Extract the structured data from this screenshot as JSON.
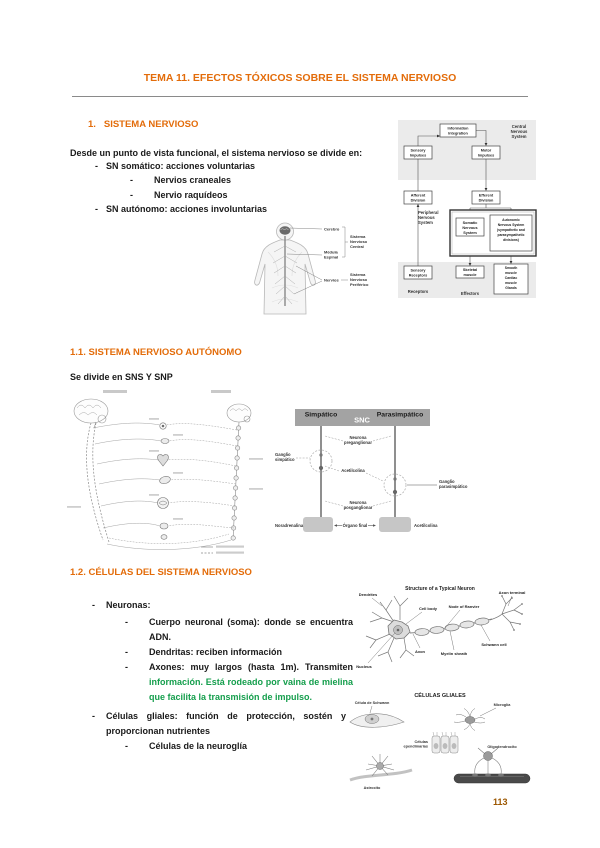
{
  "glyphs": {
    "dash": "-"
  },
  "doc": {
    "title": "TEMA 11. EFECTOS TÓXICOS SOBRE EL SISTEMA NERVIOSO",
    "page_number": "113"
  },
  "s1": {
    "heading_num": "1.",
    "heading": "SISTEMA NERVIOSO",
    "intro": "Desde un punto de vista funcional, el sistema nervioso se divide en:",
    "b1": "SN somático: acciones voluntarias",
    "b1a": "Nervios craneales",
    "b1b": "Nervio raquídeos",
    "b2": "SN autónomo: acciones involuntarias"
  },
  "s11": {
    "heading": "1.1. SISTEMA NERVIOSO AUTÓNOMO",
    "intro": "Se divide en SNS Y SNP"
  },
  "s12": {
    "heading": "1.2. CÉLULAS DEL SISTEMA NERVIOSO",
    "b1": "Neuronas:",
    "b1a": "Cuerpo neuronal (soma): donde se encuentra ADN.",
    "b1b": "Dendritas: reciben información",
    "b1c_black": "Axones: muy largos (hasta 1m). Transmiten ",
    "b1c_green": "información. Está rodeado por vaina de mielina que facilita la transmisión de impulso.",
    "b2": "Células gliales: función de protección, sostén y proporcionan nutrientes",
    "b2a": "Células de la neuroglía"
  },
  "flowchart": {
    "cns": [
      "Central",
      "Nervous",
      "System"
    ],
    "pns": [
      "Peripheral",
      "Nervous",
      "System"
    ],
    "info_integration": [
      "Information",
      "Integration"
    ],
    "sensory_impulses": [
      "Sensory",
      "Impulses"
    ],
    "motor_impulses": [
      "Motor",
      "Impulses"
    ],
    "afferent": [
      "Afferent",
      "Division"
    ],
    "efferent": [
      "Efferent",
      "Division"
    ],
    "somatic": [
      "Somatic",
      "Nervous",
      "System"
    ],
    "autonomic": [
      "Autonomic",
      "Nervous System",
      "(sympathetic and",
      "parasympathetic",
      "divisions)"
    ],
    "sensory_receptors": [
      "Sensory",
      "Receptors"
    ],
    "skeletal": [
      "Skeletal",
      "muscle"
    ],
    "smooth": [
      "Smooth",
      "muscle",
      "Cardiac",
      "muscle",
      "Glands"
    ],
    "receptors": "Receptors",
    "effectors": "Effectors"
  },
  "body_figure": {
    "cerebro": "Cerebro",
    "medula": [
      "Médula",
      "Espinal"
    ],
    "nervios": "Nervios",
    "snc": [
      "Sistema",
      "Nervioso",
      "Central"
    ],
    "snp": [
      "Sistema",
      "Nervioso",
      "Periférico"
    ]
  },
  "ans": {
    "simpatico": "Simpático",
    "snc": "SNC",
    "parasimpatico": "Parasimpático",
    "pregang": [
      "Neurona",
      "preganglionar"
    ],
    "gang_simp": [
      "Ganglio",
      "simpático"
    ],
    "acetilcolina_mid": "Acetilcolina",
    "gang_para": [
      "Ganglio",
      "parasimpático"
    ],
    "postgang": [
      "Neurona",
      "posganglionar"
    ],
    "noradrenalina": "Noradrenalina",
    "organo": "Órgano final",
    "acetilcolina_bottom": "Acetilcolina"
  },
  "neuron": {
    "title": "Structure of a Typical Neuron",
    "dendrites": "Dendrites",
    "cell_body": "Cell body",
    "nucleus": "Nucleus",
    "axon": "Axon",
    "myelin": "Myelin sheath",
    "node": "Node of Ranvier",
    "schwann": "Schwann cell",
    "terminal": "Axon terminal"
  },
  "glial": {
    "title": "CÉLULAS GLIALES",
    "schwann": "Célula de Schwann",
    "microglia": "Microglía",
    "ependymal": [
      "Células",
      "ependimarias"
    ],
    "astrocyte": "Astrocito",
    "oligo": "Oligodendrocito"
  },
  "colors": {
    "heading": "#E36C0A",
    "green": "#149E4C",
    "page_number": "#9C5700"
  }
}
